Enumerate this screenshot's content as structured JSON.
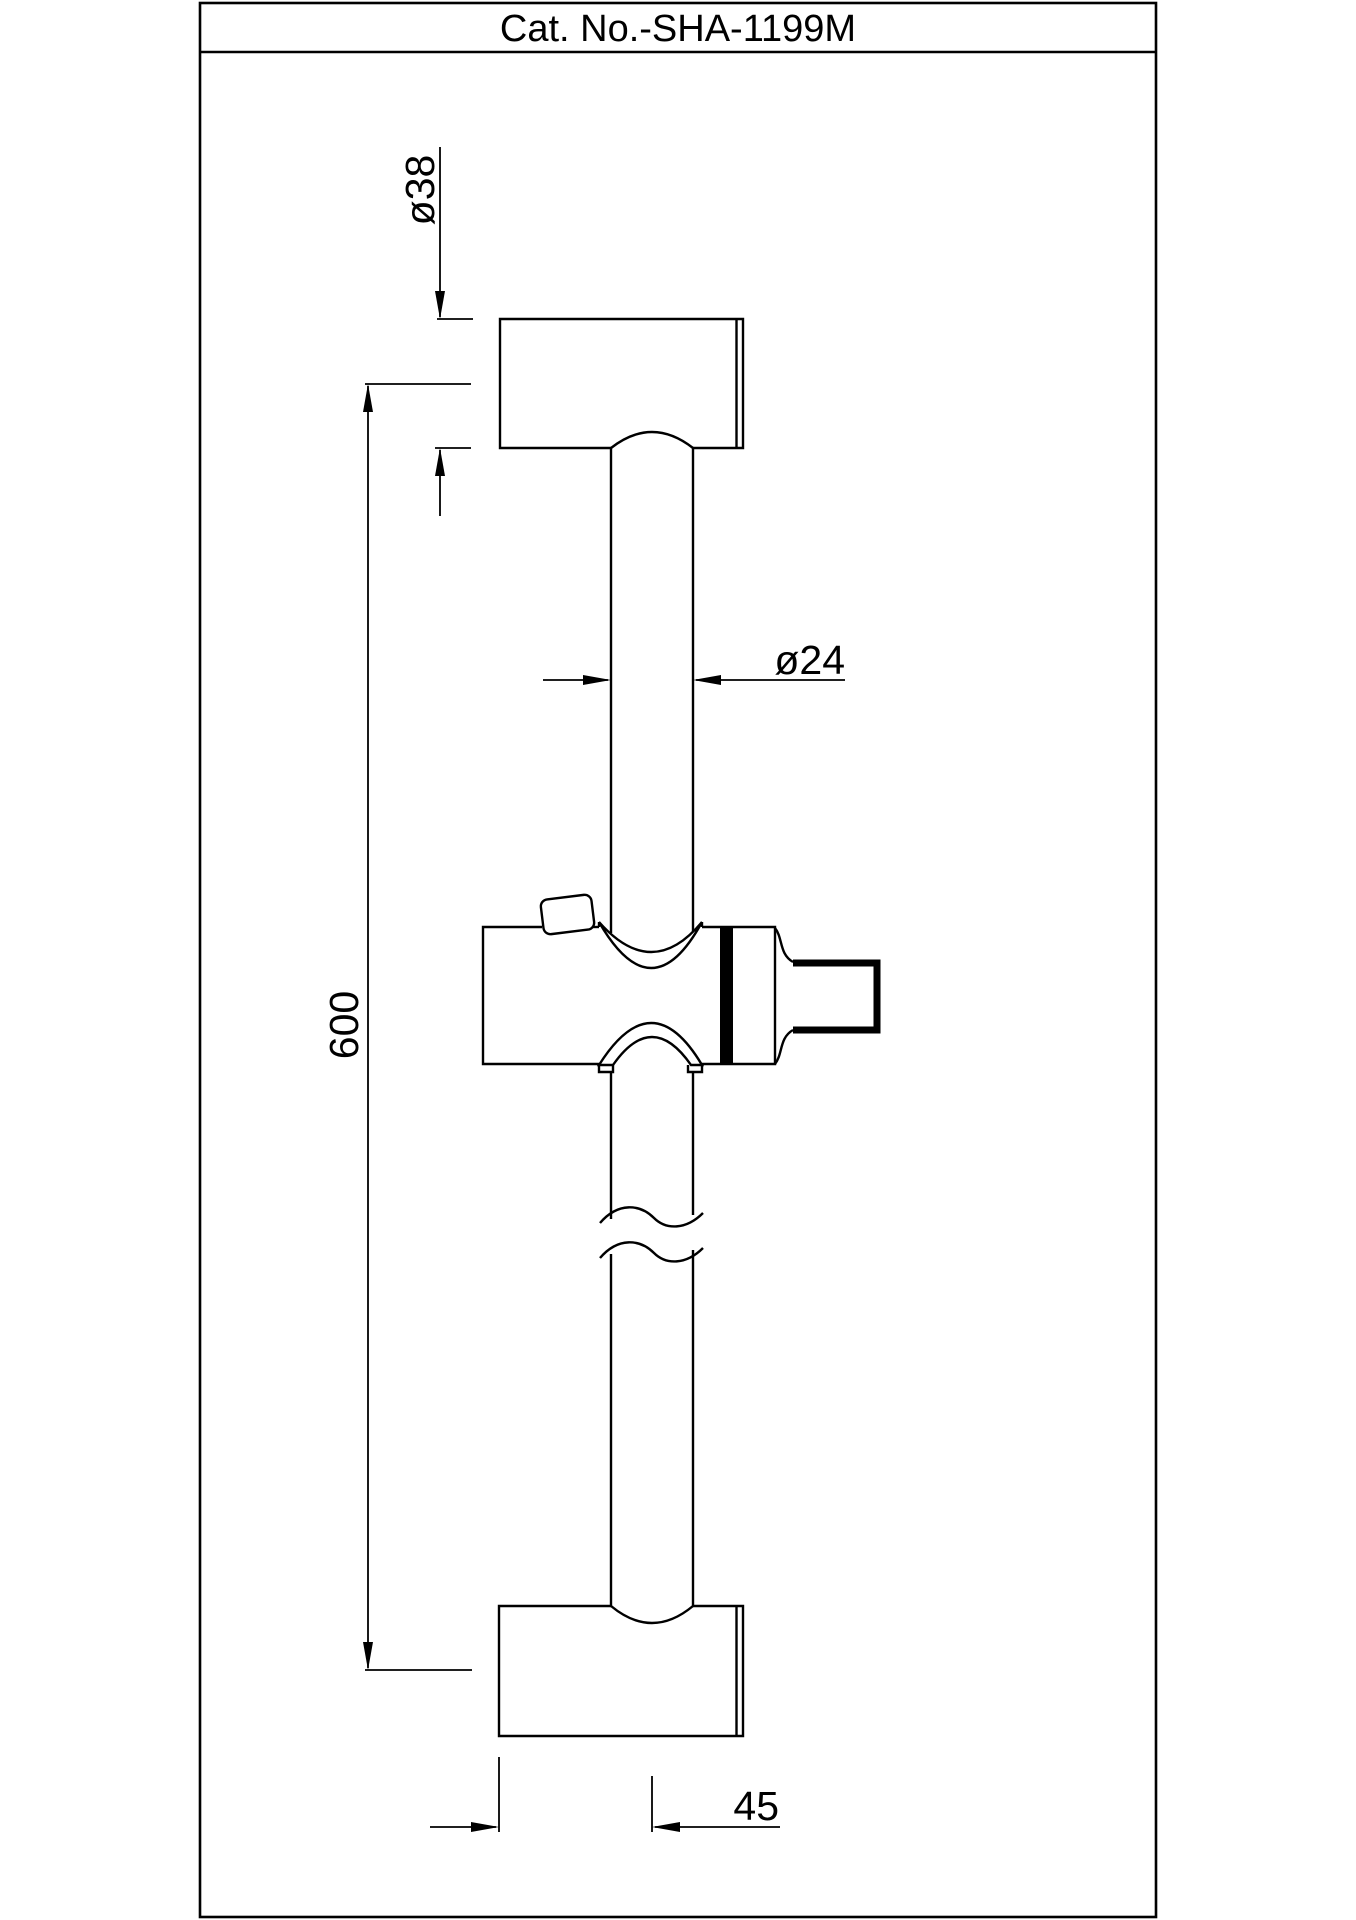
{
  "title_block": {
    "catalog_number": "Cat. No.-SHA-1199M"
  },
  "colors": {
    "line": "#000000",
    "background": "#ffffff"
  },
  "dimensions": {
    "bracket_diameter": {
      "label": "ø38",
      "value": 38
    },
    "rail_diameter": {
      "label": "ø24",
      "value": 24
    },
    "rail_length": {
      "label": "600",
      "value": 600
    },
    "wall_offset": {
      "label": "45",
      "value": 45
    }
  },
  "part": {
    "features": [
      "top wall bracket",
      "vertical slide rail",
      "adjustable slider with lock button and shower holder cup",
      "break lines on rail",
      "bottom wall bracket"
    ]
  }
}
